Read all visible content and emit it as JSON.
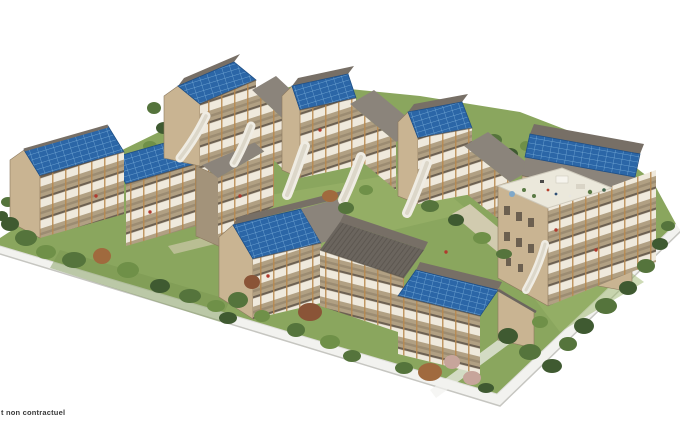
{
  "page": {
    "background": "#ffffff",
    "width": 680,
    "height": 425
  },
  "disclaimer": {
    "text": "t non contractuel"
  },
  "scene": {
    "type": "3d-architectural-rendering",
    "subject": "Aerial view of a residential eco-district: timber apartment buildings with rooftop solar panels, wooden balconies, white evacuation slides, a rooftop terrace and landscaped gardens on a diamond-shaped plot",
    "buildings": [
      {
        "id": "left-building-1",
        "roof": "solar"
      },
      {
        "id": "left-building-2",
        "roof": "solar"
      },
      {
        "id": "left-wing",
        "roof": "metal"
      },
      {
        "id": "back-row-building-1",
        "roof": "solar",
        "slide": true
      },
      {
        "id": "back-row-building-2",
        "roof": "solar",
        "slide": true
      },
      {
        "id": "back-row-building-3",
        "roof": "solar",
        "slide": true
      },
      {
        "id": "connector-1",
        "roof": "metal"
      },
      {
        "id": "connector-2",
        "roof": "metal"
      },
      {
        "id": "connector-3",
        "roof": "metal"
      },
      {
        "id": "front-building-1",
        "roof": "solar"
      },
      {
        "id": "front-building-2",
        "roof": "metal"
      },
      {
        "id": "front-building-3",
        "roof": "solar"
      },
      {
        "id": "right-building",
        "roof": "solar",
        "rooftop_terrace": true,
        "slide": true
      }
    ],
    "slides_count": 6,
    "colors": {
      "lawn": "#8aa65e",
      "lawnDark": "#789550",
      "lawnLight": "#9cb56c",
      "solar": "#2b66a7",
      "solarGrid": "#7fb3dc",
      "roof": "#8b847b",
      "roofDark": "#6b655e",
      "roofCap": "#776f66",
      "wood": "#c9b492",
      "woodDark": "#a3937a",
      "post": "#b8884e",
      "railing": "#efe9dc",
      "slab": "#6d6152",
      "balconyShade": "#b1a083",
      "slide": "#efece3",
      "deck": "#ebe8db",
      "sidewalk": "#f2f2ef",
      "sidewalkEdge": "#c6c6c1",
      "pathTan": "#d8cfb8",
      "treeDark": "#3f5a31",
      "treeMid": "#55743c",
      "treeLight": "#6f9048",
      "treeBright": "#86a658",
      "treeRust": "#a06a3e",
      "treeRed": "#8a5437",
      "blossom": "#c7a59b",
      "text": "#3a3a3a"
    }
  }
}
